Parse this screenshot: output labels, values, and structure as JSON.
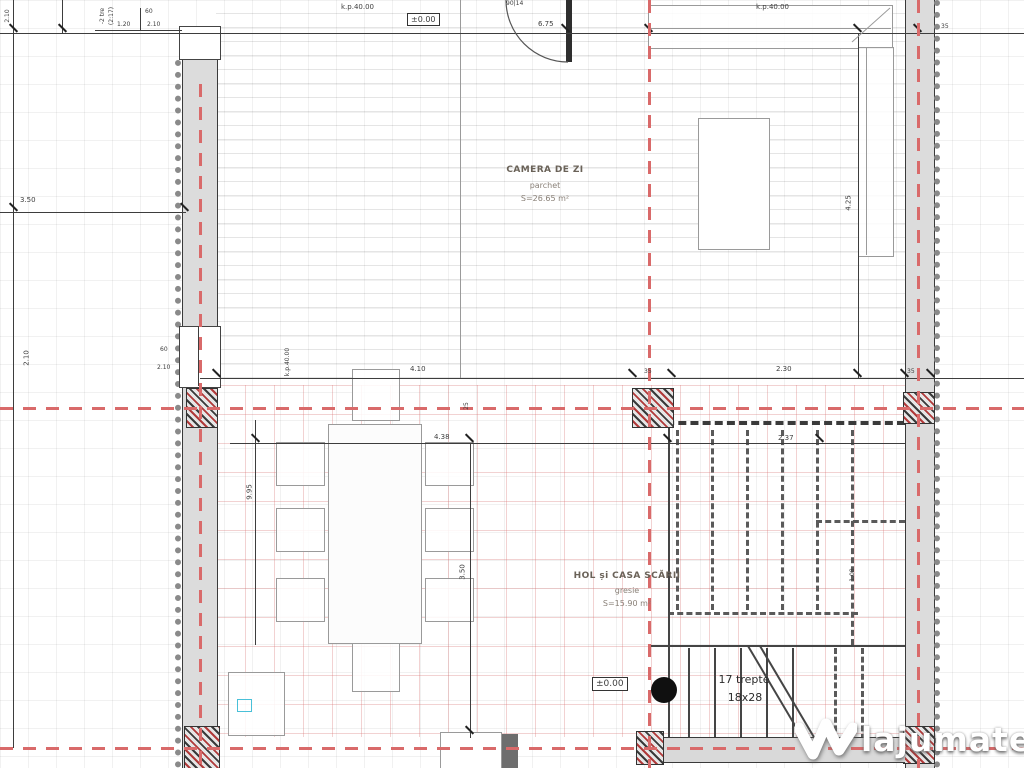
{
  "rooms": {
    "living": {
      "name": "CAMERA DE ZI",
      "floor": "parchet",
      "area": "S=26.65 m²"
    },
    "hall": {
      "name": "HOL și CASA SCĂRII",
      "floor": "gresie",
      "area": "S=15.90 m²"
    }
  },
  "stairs": {
    "count": "17 trepte",
    "size": "18x28"
  },
  "levels": {
    "main": "±0.00",
    "hall": "±0.00"
  },
  "notes": {
    "kp_left": "k.p.40.00",
    "kp_right": "k.p.40.00",
    "kp_window": "k.p.40.00",
    "door_tag": "90|14",
    "steps_1": "-2 tre",
    "steps_2": "(2:17)"
  },
  "dims": {
    "top_width": "6.75",
    "top_right_35": "35",
    "far_left_top": "2.10",
    "left_350": "3.50",
    "left_210": "2.10",
    "tl_120": "1.20",
    "tl_60": "60",
    "tl_210": "2.10",
    "win_60": "60",
    "win_210": "2.10",
    "mid_410": "4.10",
    "mid_35a": "35",
    "mid_230": "2.30",
    "mid_35b": "35",
    "mid_25": "25",
    "hall_438": "4.38",
    "hall_237": "2.37",
    "v_995": "9.95",
    "v_350": "3.50",
    "v_425": "4.25",
    "v_108": "1.08"
  },
  "watermark": {
    "brand": "lajumate",
    "tld": ".ro"
  },
  "colors": {
    "axis": "#d96a6a",
    "wall": "#dcdcdc",
    "line": "#3d3d3d",
    "tile_grid": "#d56a6a",
    "hatch_red": "#b03a3a",
    "marker": "#49c0d8"
  }
}
